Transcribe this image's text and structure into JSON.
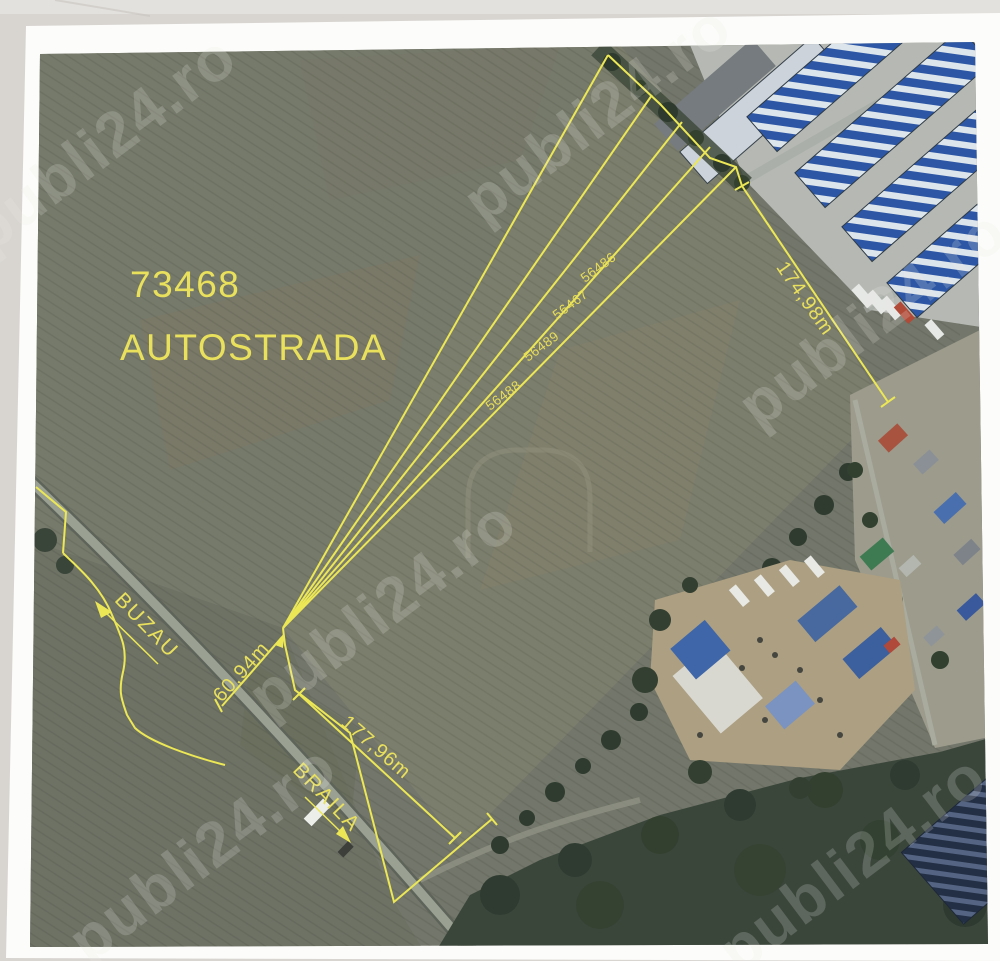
{
  "page": {
    "background_color": "#d8d5d1",
    "paper_color": "#fcfcfa"
  },
  "watermark": {
    "text": "publi24.ro"
  },
  "map": {
    "annotation_color": "#ece755",
    "plot_id": "73468",
    "plot_name": "AUTOSTRADA",
    "strip_parcels": [
      "56486",
      "56467",
      "56489",
      "56488"
    ],
    "dimension_ne": "174,98m",
    "dimension_sw": "177,96m",
    "dimension_front": "60,94m",
    "road_direction_nw": "BUZAU",
    "road_direction_se": "BRAILA"
  }
}
